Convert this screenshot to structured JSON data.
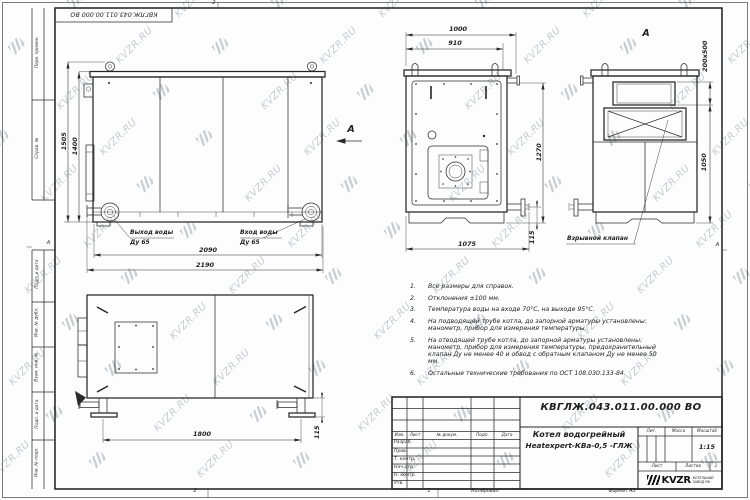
{
  "page": {
    "watermark_text": "KVZR.RU",
    "zones": {
      "top": "2",
      "left": "А",
      "right": "А"
    },
    "bottom_strip": {
      "zone_2": "2",
      "zone_1": "1",
      "copied": "Копировал",
      "format": "Формат А3"
    }
  },
  "frame": {
    "top_stamp": "КВГЛЖ.043.011.00.000 ВО",
    "side_labels": [
      "Перв. примен.",
      "Справ. №",
      "Подп. и дата",
      "Инв. № дубл.",
      "Взам. инв. №",
      "Подп. и дата",
      "Инв. № подл."
    ]
  },
  "views": {
    "front": {
      "dim_height_total": "1505",
      "dim_height_body": "1400",
      "dim_width_body": "2090",
      "dim_width_total": "2190",
      "label_outlet": "Выход воды",
      "label_outlet_dn": "Ду 65",
      "label_inlet": "Вход воды",
      "label_inlet_dn": "Ду 65",
      "view_arrow_label": "А"
    },
    "side": {
      "dim_top_total": "1000",
      "dim_top_inner": "910",
      "dim_right": "1270",
      "dim_pipe": "115",
      "dim_bottom": "1075"
    },
    "rear": {
      "view_title": "А",
      "dim_opening": "200x500",
      "dim_height": "1050",
      "label_explosion_valve": "Взрывной клапан"
    },
    "bottom": {
      "dim_length": "1800",
      "dim_foot": "115"
    }
  },
  "notes": {
    "items": [
      {
        "n": "1.",
        "text": "Все размеры для справок."
      },
      {
        "n": "2.",
        "text": "Отклонения ±100 мм."
      },
      {
        "n": "3.",
        "text": "Температура воды на входе 70°С, на выходе 95°С."
      },
      {
        "n": "4.",
        "text": "На подводящей трубе котла, до запорной арматуры установлены: манометр, прибор для измерения температуры."
      },
      {
        "n": "5.",
        "text": "На отводящей трубе котла, до запорной арматуры установлены: манометр, прибор для измерения температуры, предохранительный клапан Ду не менее 40 и обвод с обратным клапаном Ду не менее 50 мм."
      },
      {
        "n": "6.",
        "text": "Остальные технические требования по ОСТ 108.030.133-84."
      }
    ]
  },
  "title_block": {
    "doc_number": "КВГЛЖ.043.011.00.000 ВО",
    "name_line1": "Котел водогрейный",
    "name_line2": "Heatexpert-КВа-0,5 -ГЛЖ",
    "col_izm": "Изм.",
    "col_list": "Лист",
    "col_doc": "№ докум.",
    "col_podp": "Подп.",
    "col_data": "Дата",
    "rows": [
      {
        "label": "Разраб."
      },
      {
        "label": "Пров."
      },
      {
        "label": "Т. контр."
      },
      {
        "label": "Нач.отд."
      },
      {
        "label": "Н. контр."
      },
      {
        "label": "Утв."
      }
    ],
    "lit": "Лит.",
    "mass": "Масса",
    "scale_label": "Масштаб",
    "scale": "1:15",
    "sheet_label": "Лист",
    "sheets_label": "Листов",
    "sheets_value": "1",
    "logo_text": "KVZR",
    "logo_sub1": "КОТЕЛЬНЫЙ",
    "logo_sub2": "ЗАВОД РФ"
  }
}
